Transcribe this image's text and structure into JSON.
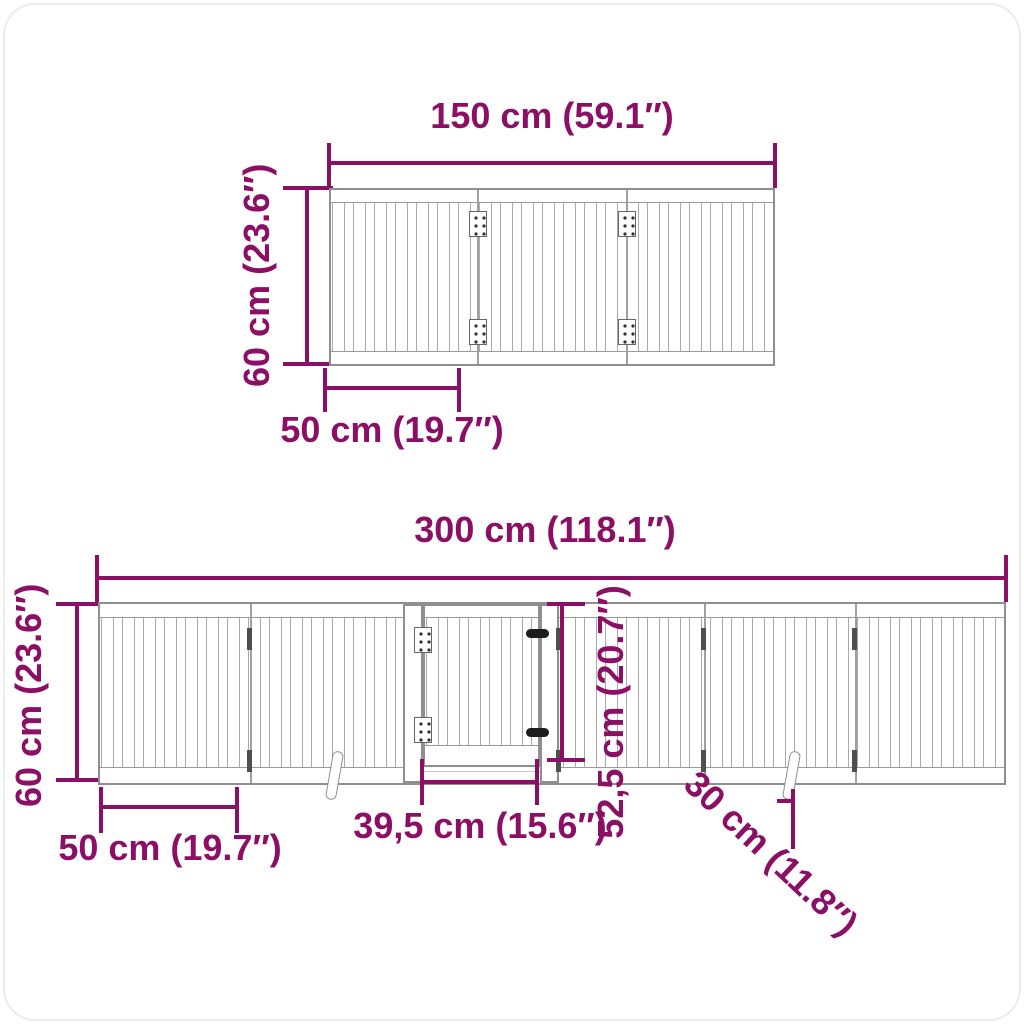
{
  "colors": {
    "accent": "#8C0F66",
    "drawing_line": "#9a9a9a"
  },
  "top_view": {
    "width_label": "150 cm (59.1″)",
    "height_label": "60 cm (23.6″)",
    "panel_width_label": "50 cm (19.7″)"
  },
  "bottom_view": {
    "width_label": "300 cm (118.1″)",
    "height_label": "60 cm (23.6″)",
    "panel_width_label": "50 cm (19.7″)",
    "door_width_label": "39,5 cm (15.6″)",
    "door_height_label": "52,5 cm (20.7″)",
    "support_foot_label": "30 cm (11.8″)"
  }
}
